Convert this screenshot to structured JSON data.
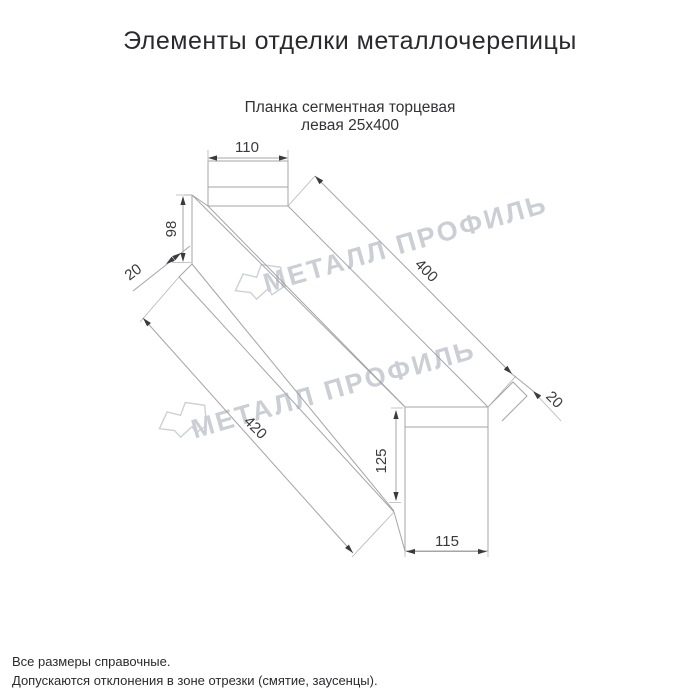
{
  "header": {
    "title": "Элементы отделки металлочерепицы"
  },
  "product": {
    "subtitle_line1": "Планка сегментная торцевая",
    "subtitle_line2": "левая 25x400"
  },
  "dimensions": {
    "top_tab_width": "110",
    "left_face_height": "98",
    "left_lip": "20",
    "length_top": "400",
    "length_bottom": "420",
    "end_face_height": "125",
    "end_face_width": "115",
    "end_lip": "20"
  },
  "watermark": {
    "text": "МЕТАЛЛ ПРОФИЛЬ",
    "color": "#cbced4"
  },
  "footer": {
    "line1": "Все размеры справочные.",
    "line2": "Допускаются отклонения в зоне отрезки (смятие, заусенцы)."
  },
  "colors": {
    "drawing_line": "#a4a4a9",
    "dimension_text": "#3a3a3f",
    "title_text": "#2a2a2e"
  }
}
